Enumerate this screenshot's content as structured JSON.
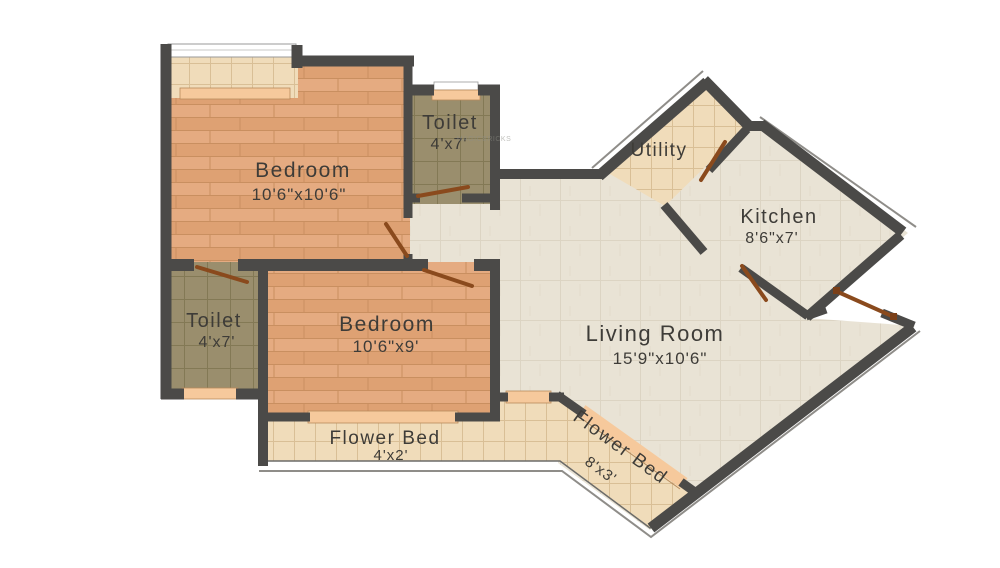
{
  "plan": {
    "rooms": {
      "bedroom_top_left": {
        "name": "Bedroom",
        "dims": "10'6\"x10'6\""
      },
      "toilet_top": {
        "name": "Toilet",
        "dims": "4'x7'"
      },
      "utility": {
        "name": "Utility"
      },
      "kitchen": {
        "name": "Kitchen",
        "dims": "8'6\"x7'"
      },
      "living_room": {
        "name": "Living Room",
        "dims": "15'9\"x10'6\""
      },
      "toilet_left": {
        "name": "Toilet",
        "dims": "4'x7'"
      },
      "bedroom_center": {
        "name": "Bedroom",
        "dims": "10'6\"x9'"
      },
      "flower_bed_bottom": {
        "name": "Flower Bed",
        "dims": "4'x2'"
      },
      "flower_bed_diagonal": {
        "name": "Flower Bed",
        "dims": "8'x3'"
      }
    },
    "watermark": "MAGICBRICKS",
    "colors": {
      "wall": "#4b4a48",
      "wood_floor": "#e2a77c",
      "beige_tile": "#f0dcba",
      "toilet_tile": "#9a8e6d",
      "living_floor": "#e9e3d5",
      "window_sill": "#f6c99c",
      "door_leaf": "#8a4a1d",
      "label_text": "#3e3c38",
      "background": "#ffffff"
    }
  }
}
